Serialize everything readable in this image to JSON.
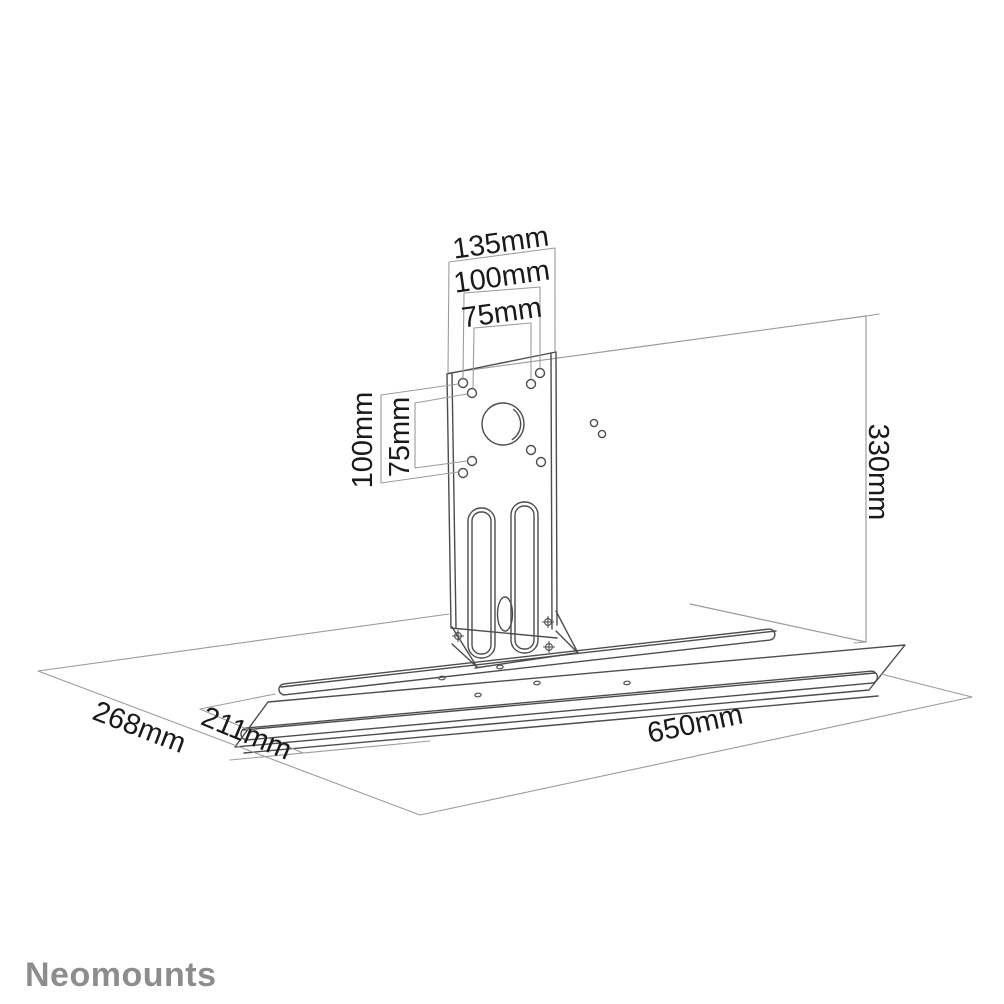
{
  "drawing": {
    "title_type": "product-dimension-diagram",
    "logo": "Neomounts",
    "dimensions": {
      "plate_width": "135mm",
      "vesa_width_100": "100mm",
      "vesa_width_75": "75mm",
      "vesa_height_100": "100mm",
      "vesa_height_75": "75mm",
      "panel_height": "330mm",
      "depth_total": "268mm",
      "depth_shelf": "211mm",
      "shelf_width": "650mm"
    },
    "colors": {
      "outline": "#4d4d4d",
      "dimension_line": "#9c9c9c",
      "label_text": "#1a1a1a",
      "logo_text": "#8d8d8d",
      "background": "#ffffff"
    }
  }
}
